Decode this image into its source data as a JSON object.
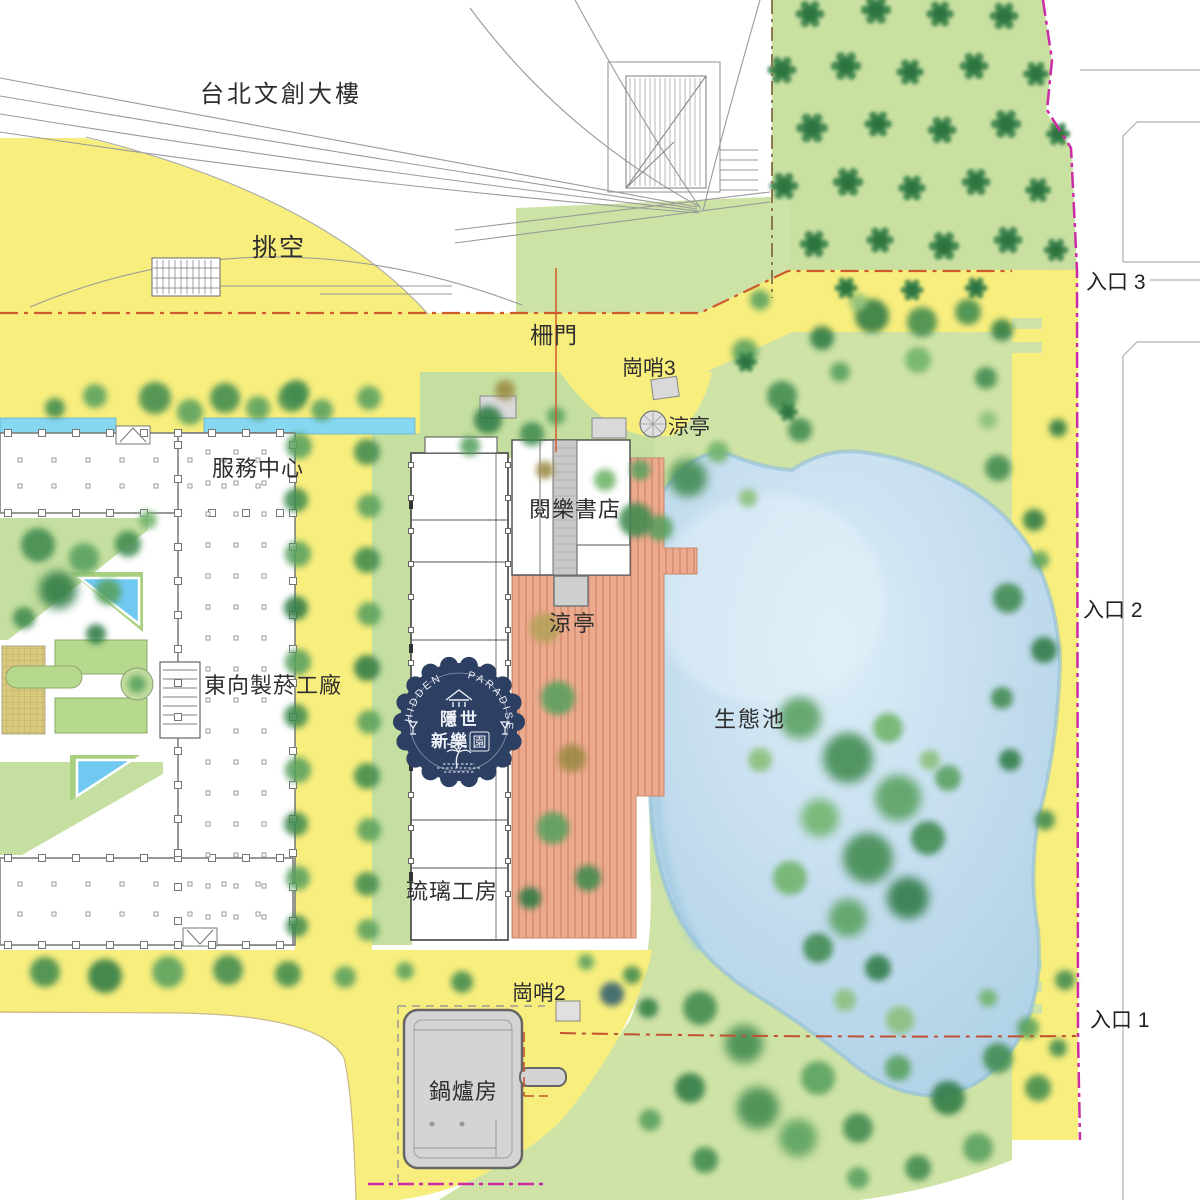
{
  "labels": {
    "taipei_building": "台北文創大樓",
    "void_space": "挑空",
    "gate": "柵門",
    "sentry3": "崗哨3",
    "pavilion_north": "涼亭",
    "service_center": "服務中心",
    "bookstore": "閱樂書店",
    "pavilion_deck": "涼亭",
    "tobacco_factory": "東向製菸工廠",
    "eco_pond": "生態池",
    "glass_studio": "琉璃工房",
    "sentry2": "崗哨2",
    "boiler_room": "鍋爐房",
    "entrance3": "入口 3",
    "entrance2": "入口 2",
    "entrance1": "入口 1"
  },
  "logo": {
    "arc_left": "HIDDEN",
    "arc_right": "PARADISE",
    "line1": "隱世",
    "line2": "新樂",
    "line2_seal": "園"
  },
  "colors": {
    "path_yellow": "#f8ee7e",
    "lawn_green": "#cfe3a6",
    "grove_green": "#c9e0a0",
    "pond_blue": "#bcd9ea",
    "deck_salmon": "#ecab8e",
    "water_cyan": "#86d7f2",
    "boundary_magenta": "#cb2ba6",
    "boundary_red": "#cf5b2c",
    "boundary_olive": "#8a7a50",
    "building_gray": "#d4d4d4",
    "logo_navy": "#2d3f63"
  }
}
